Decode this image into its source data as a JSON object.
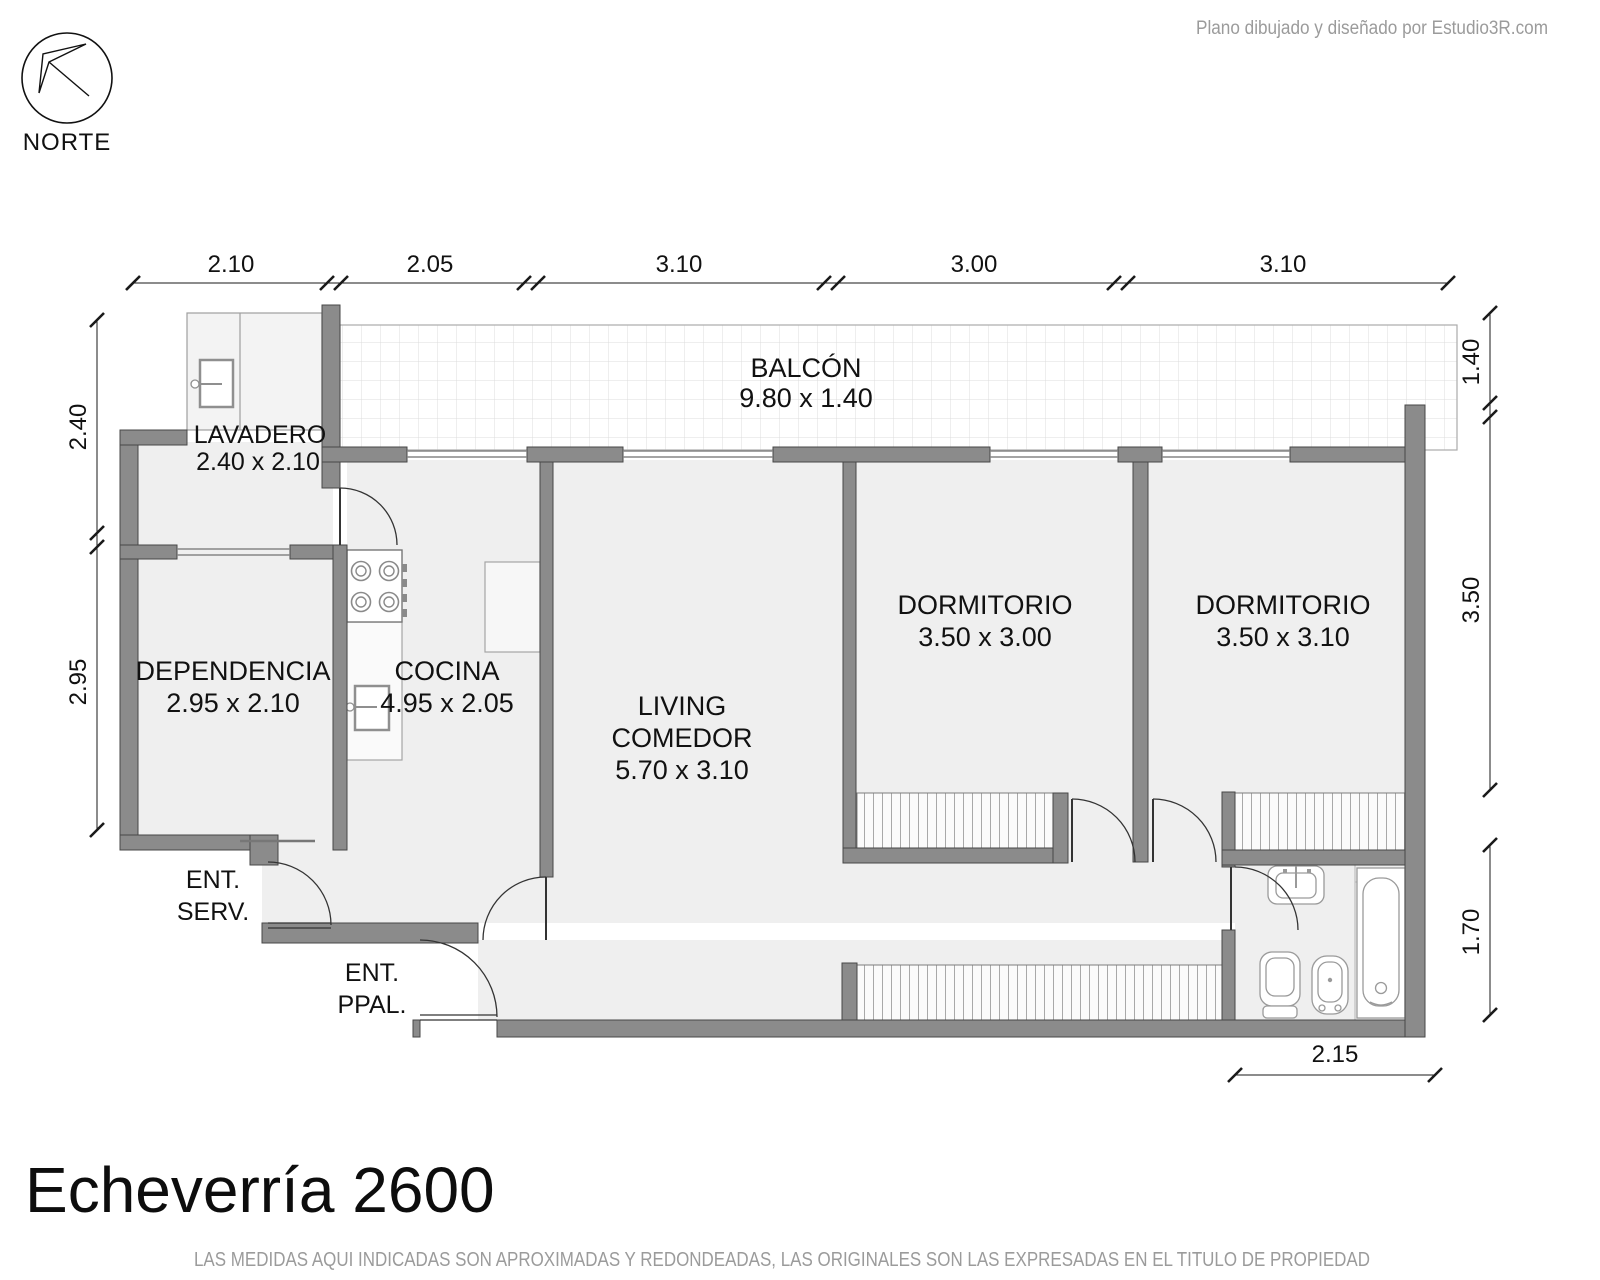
{
  "credit": "Plano dibujado y diseñado por Estudio3R.com",
  "north": {
    "label": "NORTE"
  },
  "title": "Echeverría 2600",
  "disclaimer": "LAS MEDIDAS AQUI INDICADAS SON APROXIMADAS Y REDONDEADAS, LAS ORIGINALES SON LAS EXPRESADAS EN EL TITULO DE PROPIEDAD",
  "rooms": {
    "balcon": {
      "name": "BALCÓN",
      "size": "9.80 x 1.40"
    },
    "lavadero": {
      "name": "LAVADERO",
      "size": "2.40 x 2.10"
    },
    "dependencia": {
      "name": "DEPENDENCIA",
      "size": "2.95 x 2.10"
    },
    "cocina": {
      "name": "COCINA",
      "size": "4.95 x 2.05"
    },
    "living": {
      "line1": "LIVING",
      "line2": "COMEDOR",
      "size": "5.70 x 3.10"
    },
    "dormitorio1": {
      "name": "DORMITORIO",
      "size": "3.50 x 3.00"
    },
    "dormitorio2": {
      "name": "DORMITORIO",
      "size": "3.50 x 3.10"
    },
    "ent_serv": {
      "line1": "ENT.",
      "line2": "SERV."
    },
    "ent_ppal": {
      "line1": "ENT.",
      "line2": "PPAL."
    }
  },
  "dimensions": {
    "top": [
      "2.10",
      "2.05",
      "3.10",
      "3.00",
      "3.10"
    ],
    "left": [
      "2.40",
      "2.95"
    ],
    "right": [
      "1.40",
      "3.50",
      "1.70"
    ],
    "bottom": [
      "2.15"
    ]
  },
  "colors": {
    "wall": "#8b8b8b",
    "floor": "#efefef",
    "accent_text": "#111111",
    "muted_text": "#9b9b9b"
  }
}
